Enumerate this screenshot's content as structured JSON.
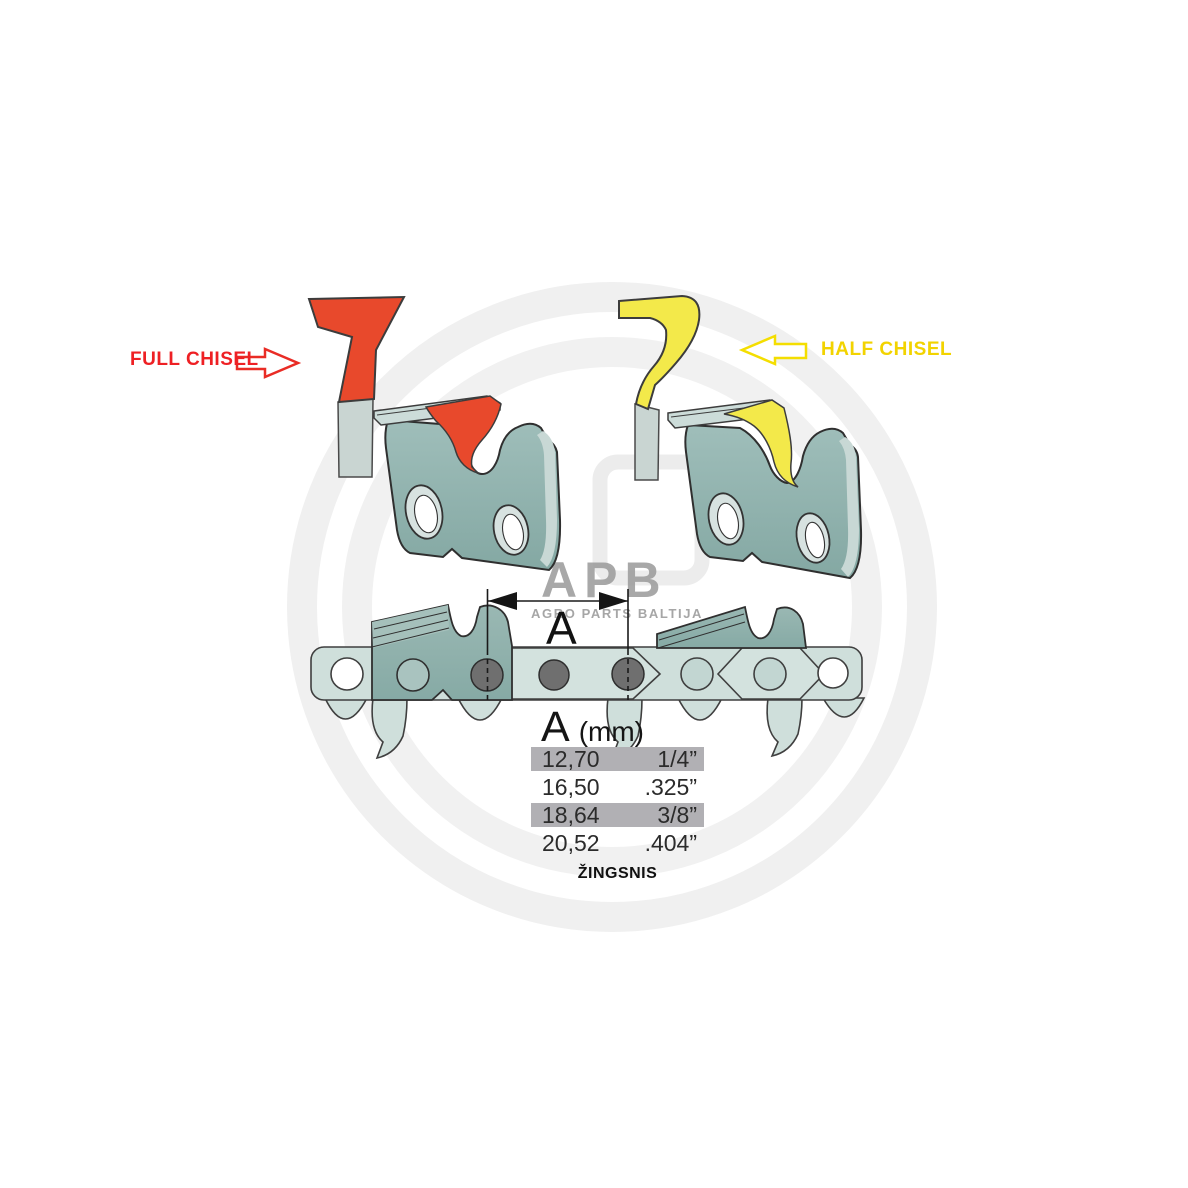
{
  "labels": {
    "full_chisel": "FULL CHISEL",
    "half_chisel": "HALF CHISEL"
  },
  "dimension": {
    "label": "A"
  },
  "pitch_table": {
    "header_letter": "A",
    "header_unit": "(mm)",
    "rows": [
      {
        "mm": "12,70",
        "inch": "1/4”",
        "highlight": true
      },
      {
        "mm": "16,50",
        "inch": ".325”",
        "highlight": false
      },
      {
        "mm": "18,64",
        "inch": "3/8”",
        "highlight": true
      },
      {
        "mm": "20,52",
        "inch": ".404”",
        "highlight": false
      }
    ],
    "caption": "ŽINGSNIS"
  },
  "watermark": {
    "logo": "APB",
    "subtitle": "AGRO PARTS BALTIJA"
  },
  "colors": {
    "label_red": "#ee2024",
    "label_yellow": "#f2d300",
    "chisel_red": "#e8492c",
    "chisel_yellow": "#f3e94a",
    "teal_light": "#cfdfdb",
    "teal_mid": "#8fb2ae",
    "row_gray": "#b1b0b4",
    "rivet_dark": "#6f6f6f",
    "watermark_gray": "#efefef"
  }
}
